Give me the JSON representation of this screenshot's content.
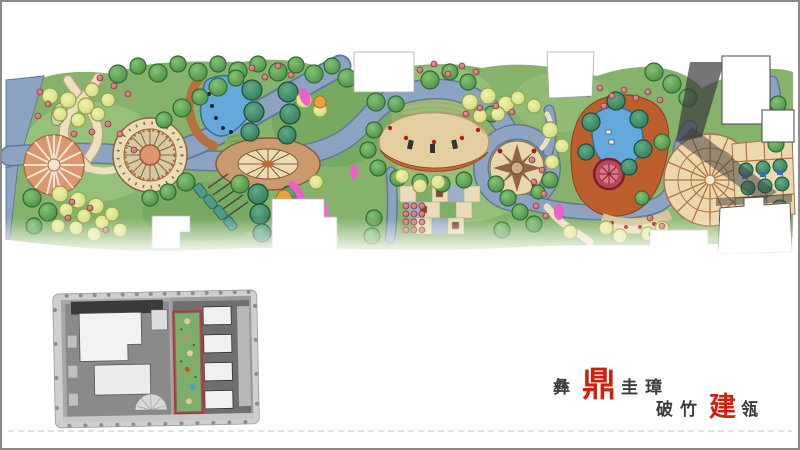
{
  "slide": {
    "background": "#ffffff",
    "border_color": "#8a8a8a",
    "separator_style": "dashed",
    "separator_color": "#c4c4c4"
  },
  "masterplan": {
    "kind": "color-landscape-masterplan-band",
    "features": [
      "left-street-road",
      "fan-terrace-plaza-left",
      "mosaic-circle-plaza",
      "crossing-garden-paths",
      "kidney-pond-with-boulders",
      "oval-sundial-lawn-plaza",
      "tree-lined-axis",
      "pergola-with-green-pavilions",
      "curved-amphitheater",
      "eight-point-star-plaza",
      "checkerboard-paving-court",
      "red-shrub-parterre",
      "terracotta-lake-deck",
      "blue-lake",
      "round-red-feature-pavilion",
      "radial-fan-plaza-right",
      "entry-courtyard-garden",
      "building-footprints"
    ],
    "palette": {
      "lawn_green": "#86b26c",
      "lawn_light": "#a4cd86",
      "road_blue_gray": "#8ca4c1",
      "road_edge": "#62799a",
      "path_cream": "#ece0bf",
      "plaza_cream": "#ecdcb4",
      "plaza_salmon": "#dc9670",
      "plaza_tan": "#c89a6e",
      "deck_terracotta": "#bc5f2c",
      "water_blue": "#64a8dc",
      "tree_green": "#4e8c46",
      "tree_yellow": "#cfd97e",
      "tree_teal": "#2f7a58",
      "shrub_red": "#b55e5e",
      "accent_magenta": "#ee5fc8",
      "accent_orange": "#e8a13c",
      "shadow_dark": "#3b3b3b",
      "building_white": "#ffffff"
    }
  },
  "site_key_plan": {
    "kind": "grayscale-site-key-plan",
    "highlight_box_color": "#cc2a2a",
    "palette": {
      "ground_gray": "#a8a8a8",
      "road_gray": "#cfcfcf",
      "block_dark": "#6f6f6f",
      "shadow_black": "#3a3a3a",
      "building_white": "#f2f2f2",
      "highlight_strip_green": "#7fae6a"
    }
  },
  "seal": {
    "line1": {
      "pre": "彝",
      "accent": "鼎",
      "post": "圭璋"
    },
    "line2": {
      "pre": "破竹",
      "accent": "建",
      "post": "瓴"
    },
    "text_color": "#3b3b3b",
    "accent_color": "#cc2310"
  }
}
